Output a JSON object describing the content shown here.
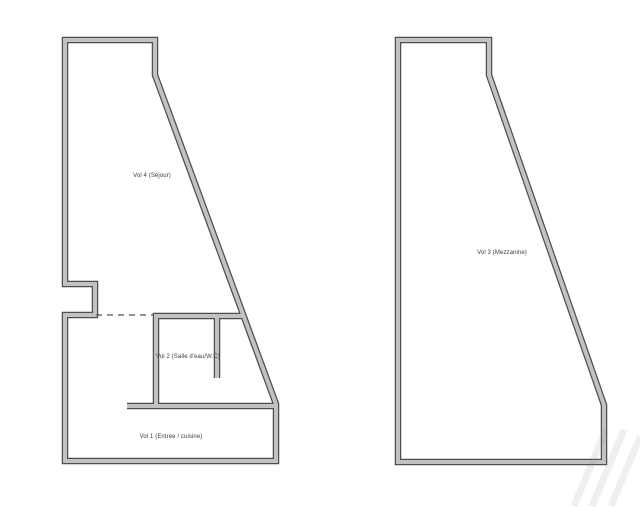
{
  "canvas": {
    "background": "#ffffff"
  },
  "floorplan": {
    "wall_core_color": "#c2c2c2",
    "wall_edge_color": "#4e4e4e",
    "dashed_line_color": "#555555",
    "label_color": "#3c3c3c",
    "left_plan": {
      "labels": {
        "vol4": "Vol 4 (Séjour)",
        "vol2": "Vol 2 (Salle d'eau/W.C)",
        "vol1": "Vol 1 (Entrée / cuisine)"
      }
    },
    "right_plan": {
      "labels": {
        "vol3": "Vol 3 (Mezzanine)"
      }
    }
  }
}
